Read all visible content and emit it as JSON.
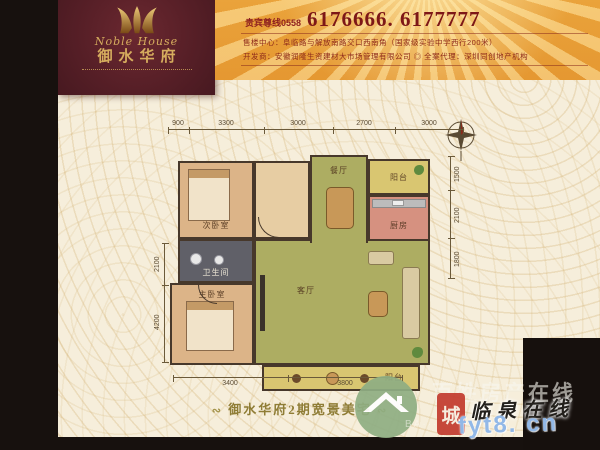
{
  "brand": {
    "name_en": "Noble House",
    "name_cn": "御水华府",
    "crown_icon": "crown-w-icon"
  },
  "header": {
    "vip_label": "贵宾尊线0558",
    "phone_numbers": "6176666. 6177777",
    "sales_line": "售楼中心：阜临路与解放南路交口西南角（国家级实验中学西行200米）",
    "developer_line": "开发商：安徽润隆生资建材大市场管理有限公司 ◎ 全案代理：深圳同创地产机构"
  },
  "plan": {
    "rooms": {
      "bedroom2": {
        "label": "次卧室"
      },
      "dining": {
        "label": "餐厅"
      },
      "balcony_top": {
        "label": "阳台"
      },
      "kitchen": {
        "label": "厨房"
      },
      "bath": {
        "label": "卫生间"
      },
      "master": {
        "label": "主卧室"
      },
      "living": {
        "label": "客厅"
      },
      "balcony_bottom": {
        "label": "阳台"
      }
    },
    "dims_top": [
      "900",
      "3300",
      "3000",
      "2700",
      "3000"
    ],
    "dims_bottom": [
      "3400",
      "3800"
    ],
    "dims_left": [
      "2100",
      "4200"
    ],
    "dims_right": [
      "1500",
      "2100",
      "1800"
    ]
  },
  "slogan": {
    "flourish_left": "∾",
    "text": "御水华府2期宽景美宅",
    "flourish_right": "∾"
  },
  "watermark": {
    "site_name_large": "百姓房产在线",
    "url_fragment": "BA····8464©··om",
    "seal_char": "城",
    "script_text": "临泉在线",
    "domain": "fyt8. cn"
  },
  "colors": {
    "brand_maroon": "#571f27",
    "brand_gold": "#d6ad5e",
    "header_orange": "#edaa43",
    "phone_red": "#7d1717",
    "body_cream": "#f6eedb",
    "plan_green": "#adad62",
    "plan_wood": "#dcb488",
    "slogan_olive": "#8f7d36",
    "watermark_blue": "#8cb4e6",
    "watermark_green": "#8fae83",
    "seal_red": "#c23b2e"
  }
}
